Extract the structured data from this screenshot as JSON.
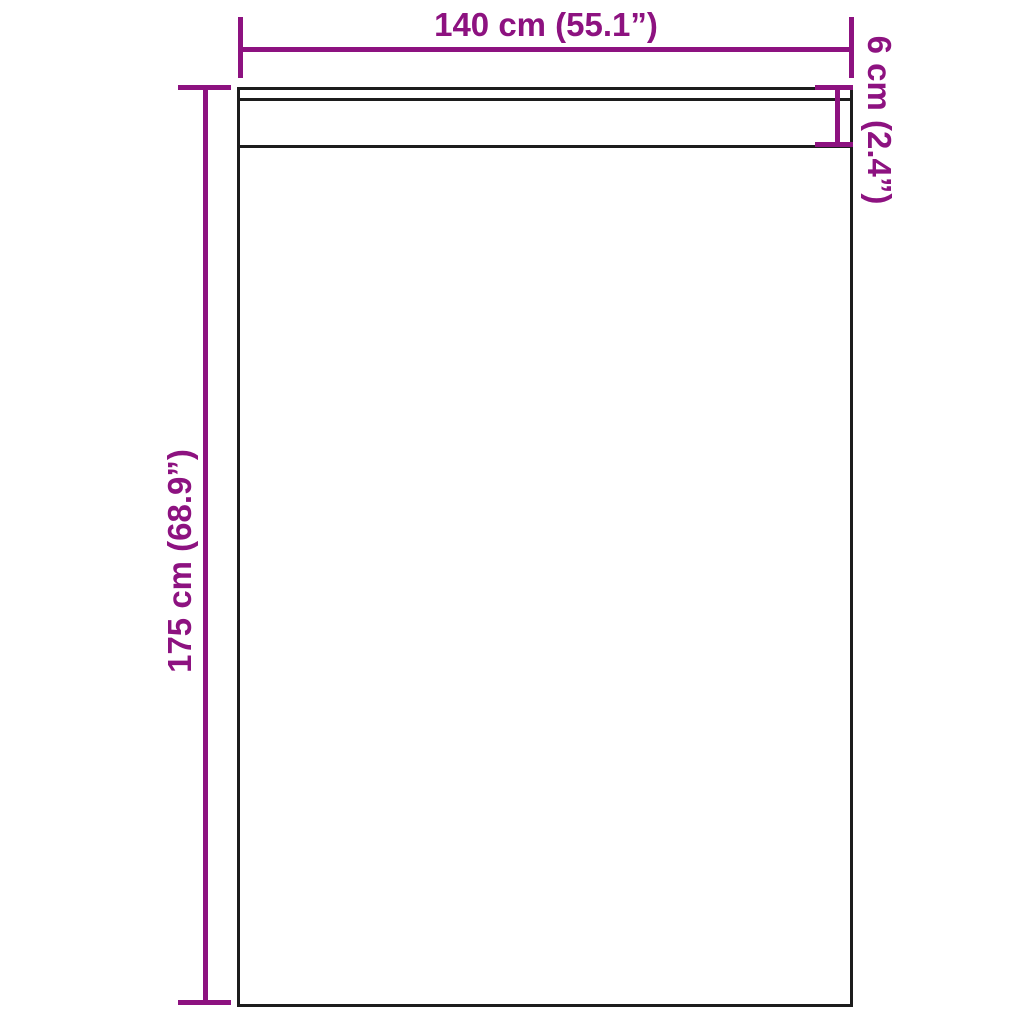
{
  "diagram": {
    "labels": {
      "width": "140 cm (55.1”)",
      "height": "175 cm (68.9”)",
      "band": "6 cm (2.4”)"
    },
    "colors": {
      "dimension_accent": "#8D1280",
      "panel_outline": "#1C1C1C",
      "background": "#FFFFFF"
    }
  }
}
